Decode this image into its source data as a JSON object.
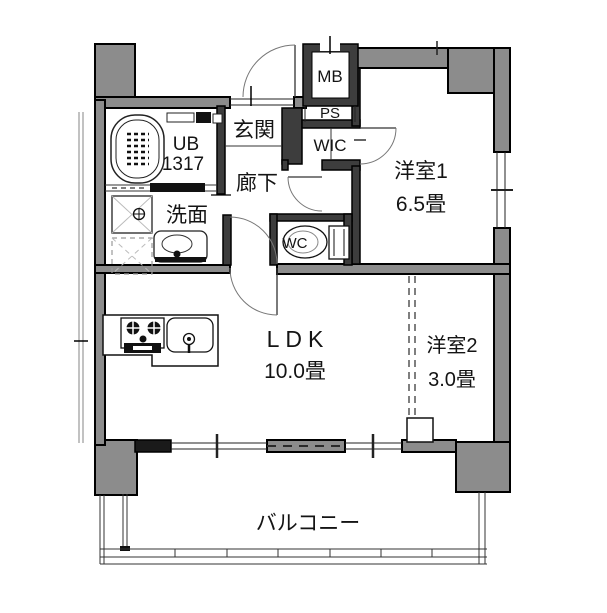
{
  "floorplan": {
    "unit_bath": {
      "label": "UB",
      "size": "1317"
    },
    "entrance_label": "玄関",
    "corridor_label": "廊下",
    "washroom_label": "洗面",
    "meter_box_label": "MB",
    "pipe_space_label": "PS",
    "closet_label": "WIC",
    "toilet_label": "WC",
    "room1": {
      "name": "洋室1",
      "area": "6.5畳"
    },
    "ldk": {
      "name": "LDK",
      "area": "10.0畳"
    },
    "room2": {
      "name": "洋室2",
      "area": "3.0畳"
    },
    "balcony_label": "バルコニー",
    "colors": {
      "wall_gray": "#8c8c8c",
      "wall_dark": "#3d3d3d",
      "black": "#111111",
      "bg": "#ffffff"
    }
  }
}
